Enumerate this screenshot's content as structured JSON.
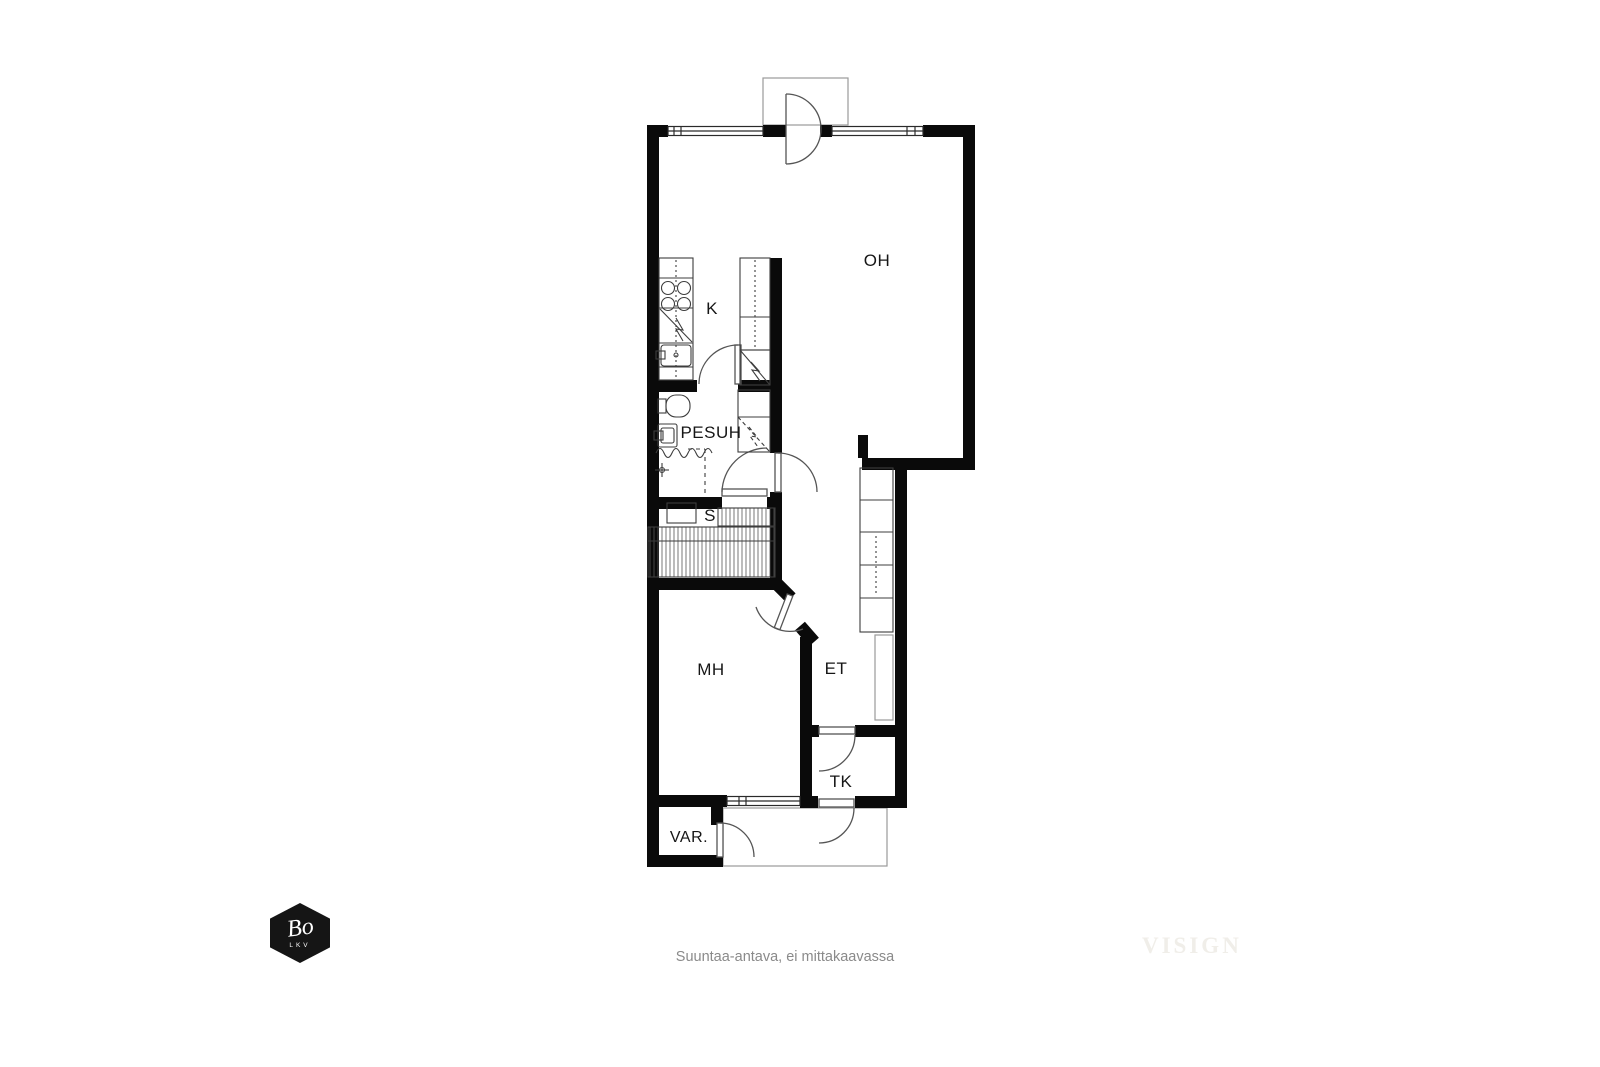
{
  "page": {
    "background_color": "#ffffff",
    "footer_note": "Suuntaa-antava, ei mittakaavassa",
    "watermark": "VISIGN"
  },
  "logo": {
    "name": "Bo",
    "subtitle": "LKV",
    "shape": "hexagon",
    "color": "#151515",
    "text_color": "#ffffff"
  },
  "floorplan": {
    "type": "apartment-floor-plan",
    "colors": {
      "wall": "#0a0a0a",
      "fixture_line": "#3d3d3d",
      "door_line": "#555555",
      "light_outline": "#9a9a9a",
      "label": "#161616",
      "hatch": "#555555"
    },
    "rooms": {
      "oh": "OH",
      "k": "K",
      "pesuh": "PESUH",
      "s": "S",
      "mh": "MH",
      "et": "ET",
      "tk": "TK",
      "var": "VAR."
    },
    "fixtures": [
      "stove-icon",
      "dishwasher-icon",
      "kitchen-sink-icon",
      "tall-cabinet-icon",
      "fridge-icon",
      "toilet-icon",
      "washbasin-icon",
      "shower-icon",
      "water-heater-icon",
      "sauna-stove-icon",
      "sauna-bench-icon",
      "wardrobe-icon"
    ],
    "doors": [
      "balcony-door",
      "kitchen-door",
      "pesuh-door",
      "sauna-door",
      "mh-door",
      "tk-door",
      "entrance-door",
      "var-door"
    ],
    "windows": 3
  }
}
